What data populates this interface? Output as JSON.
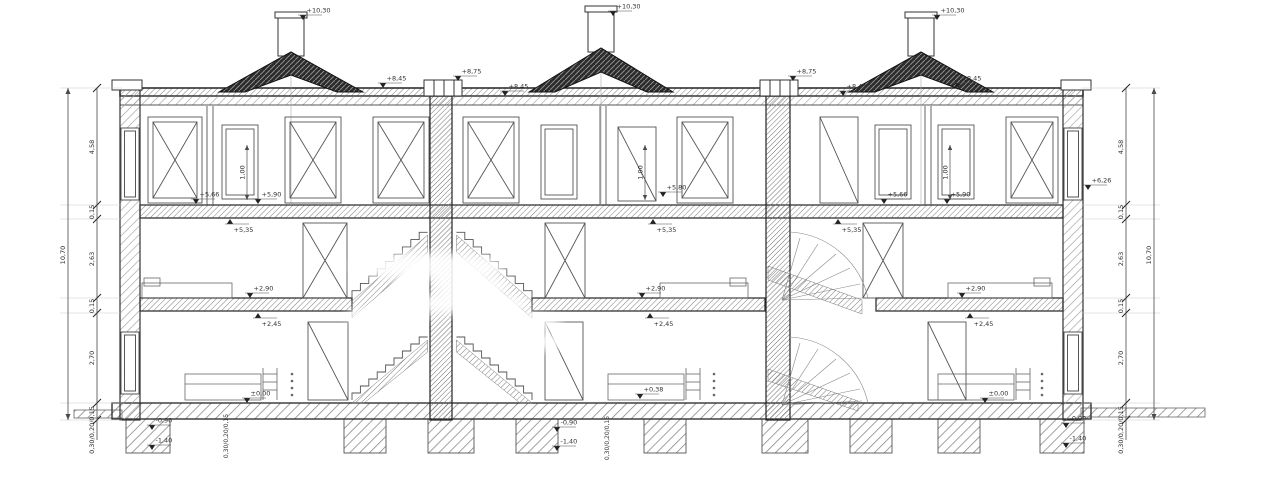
{
  "drawing": {
    "type": "architectural-building-cross-section",
    "units": 3
  },
  "colors": {
    "paper": "#ffffff",
    "line": "#4a4a4a",
    "dark": "#1d1d1d",
    "annotation": "#333333"
  },
  "dim_chains": [
    {
      "name": "dim-chain-left",
      "seg_x": 97,
      "total_x": 68,
      "ticks": [
        88,
        205,
        219,
        298,
        313,
        403,
        420
      ],
      "seg_end": 440,
      "labels": [
        {
          "text": "4,58",
          "y": 147
        },
        {
          "text": "0,15",
          "y": 212
        },
        {
          "text": "2,63",
          "y": 259
        },
        {
          "text": "0,15",
          "y": 306
        },
        {
          "text": "2,70",
          "y": 358
        },
        {
          "text": "0,30/0,20/0,15",
          "y": 430
        }
      ],
      "total": {
        "text": "10,70",
        "y": 255
      },
      "ext": [
        60,
        122
      ]
    },
    {
      "name": "dim-chain-right",
      "seg_x": 1126,
      "total_x": 1154,
      "ticks": [
        88,
        205,
        219,
        298,
        313,
        403,
        420
      ],
      "seg_end": 440,
      "labels": [
        {
          "text": "4,58",
          "y": 147
        },
        {
          "text": "0,15",
          "y": 212
        },
        {
          "text": "2,63",
          "y": 259
        },
        {
          "text": "0,15",
          "y": 306
        },
        {
          "text": "2,70",
          "y": 358
        },
        {
          "text": "0,30/0,20/0,15",
          "y": 430
        }
      ],
      "total": {
        "text": "10,70",
        "y": 255
      },
      "ext": [
        1081,
        1160
      ]
    }
  ],
  "annotations": [
    {
      "name": "level-chimney-left",
      "text": "+10,30",
      "x": 303,
      "y": 20,
      "dir": "down"
    },
    {
      "name": "level-chimney-mid",
      "text": "+10,30",
      "x": 613,
      "y": 16,
      "dir": "down"
    },
    {
      "name": "level-chimney-right",
      "text": "+10,30",
      "x": 937,
      "y": 20,
      "dir": "down"
    },
    {
      "name": "level-roof-left",
      "text": "+8,45",
      "x": 383,
      "y": 88,
      "dir": "down"
    },
    {
      "name": "level-parapet-a",
      "text": "+8,75",
      "x": 458,
      "y": 81,
      "dir": "down"
    },
    {
      "name": "level-roof-mid",
      "text": "+8,45",
      "x": 505,
      "y": 96,
      "dir": "down"
    },
    {
      "name": "level-parapet-b",
      "text": "+8,75",
      "x": 793,
      "y": 81,
      "dir": "down"
    },
    {
      "name": "level-roof-right1",
      "text": "+8,45",
      "x": 843,
      "y": 96,
      "dir": "down"
    },
    {
      "name": "level-roof-right2",
      "text": "+8,45",
      "x": 958,
      "y": 88,
      "dir": "down"
    },
    {
      "name": "level-attic-floor-1a",
      "text": "+5,66",
      "x": 196,
      "y": 204,
      "dir": "down"
    },
    {
      "name": "level-attic-floor-1b",
      "text": "+5,90",
      "x": 258,
      "y": 204,
      "dir": "down"
    },
    {
      "name": "level-attic-ceil-1",
      "text": "+5,35",
      "x": 230,
      "y": 219,
      "dir": "up"
    },
    {
      "name": "level-attic-floor-2",
      "text": "+5,80",
      "x": 663,
      "y": 197,
      "dir": "down"
    },
    {
      "name": "level-attic-ceil-2",
      "text": "+5,35",
      "x": 653,
      "y": 219,
      "dir": "up"
    },
    {
      "name": "level-attic-ceil-2b",
      "text": "+5,35",
      "x": 838,
      "y": 219,
      "dir": "up"
    },
    {
      "name": "level-attic-floor-3a",
      "text": "+5,66",
      "x": 884,
      "y": 204,
      "dir": "down"
    },
    {
      "name": "level-attic-floor-3b",
      "text": "+5,90",
      "x": 947,
      "y": 204,
      "dir": "down"
    },
    {
      "name": "level-right-wall",
      "text": "+6,26",
      "x": 1088,
      "y": 190,
      "dir": "down"
    },
    {
      "name": "level-mid-floor-1",
      "text": "+2,90",
      "x": 250,
      "y": 298,
      "dir": "down"
    },
    {
      "name": "level-mid-ceil-1",
      "text": "+2,45",
      "x": 258,
      "y": 313,
      "dir": "up"
    },
    {
      "name": "level-mid-floor-2",
      "text": "+2,90",
      "x": 642,
      "y": 298,
      "dir": "down"
    },
    {
      "name": "level-mid-ceil-2",
      "text": "+2,45",
      "x": 650,
      "y": 313,
      "dir": "up"
    },
    {
      "name": "level-mid-floor-3",
      "text": "+2,90",
      "x": 962,
      "y": 298,
      "dir": "down"
    },
    {
      "name": "level-mid-ceil-3",
      "text": "+2,45",
      "x": 970,
      "y": 313,
      "dir": "up"
    },
    {
      "name": "level-ground-1",
      "text": "±0,00",
      "x": 247,
      "y": 403,
      "dir": "down"
    },
    {
      "name": "level-ground-2",
      "text": "+0,38",
      "x": 640,
      "y": 399,
      "dir": "down"
    },
    {
      "name": "level-ground-3",
      "text": "±0,00",
      "x": 985,
      "y": 403,
      "dir": "down"
    },
    {
      "name": "level-found-1a",
      "text": "-0,90",
      "x": 152,
      "y": 430,
      "dir": "down"
    },
    {
      "name": "level-found-1b",
      "text": "-1,40",
      "x": 152,
      "y": 450,
      "dir": "down"
    },
    {
      "name": "level-found-2a",
      "text": "-0,90",
      "x": 557,
      "y": 432,
      "dir": "down"
    },
    {
      "name": "level-found-2b",
      "text": "-1,40",
      "x": 557,
      "y": 451,
      "dir": "down"
    },
    {
      "name": "level-found-3a",
      "text": "-0,90",
      "x": 1066,
      "y": 428,
      "dir": "down"
    },
    {
      "name": "level-found-3b",
      "text": "-1,40",
      "x": 1066,
      "y": 448,
      "dir": "down"
    },
    {
      "name": "dim-attic-window-1",
      "type": "vdim",
      "text": "1,00",
      "x": 247,
      "y1": 145,
      "y2": 200
    },
    {
      "name": "dim-attic-window-2",
      "type": "vdim",
      "text": "1,00",
      "x": 645,
      "y1": 145,
      "y2": 200
    },
    {
      "name": "dim-attic-window-3",
      "type": "vdim",
      "text": "1,00",
      "x": 950,
      "y1": 145,
      "y2": 200
    },
    {
      "name": "dim-foundation-left",
      "type": "text",
      "rot": true,
      "text": "0,30/0,20/0,15",
      "x": 228,
      "y": 436
    },
    {
      "name": "dim-foundation-mid",
      "type": "text",
      "rot": true,
      "text": "0,30/0,20/0,15",
      "x": 609,
      "y": 438
    }
  ]
}
